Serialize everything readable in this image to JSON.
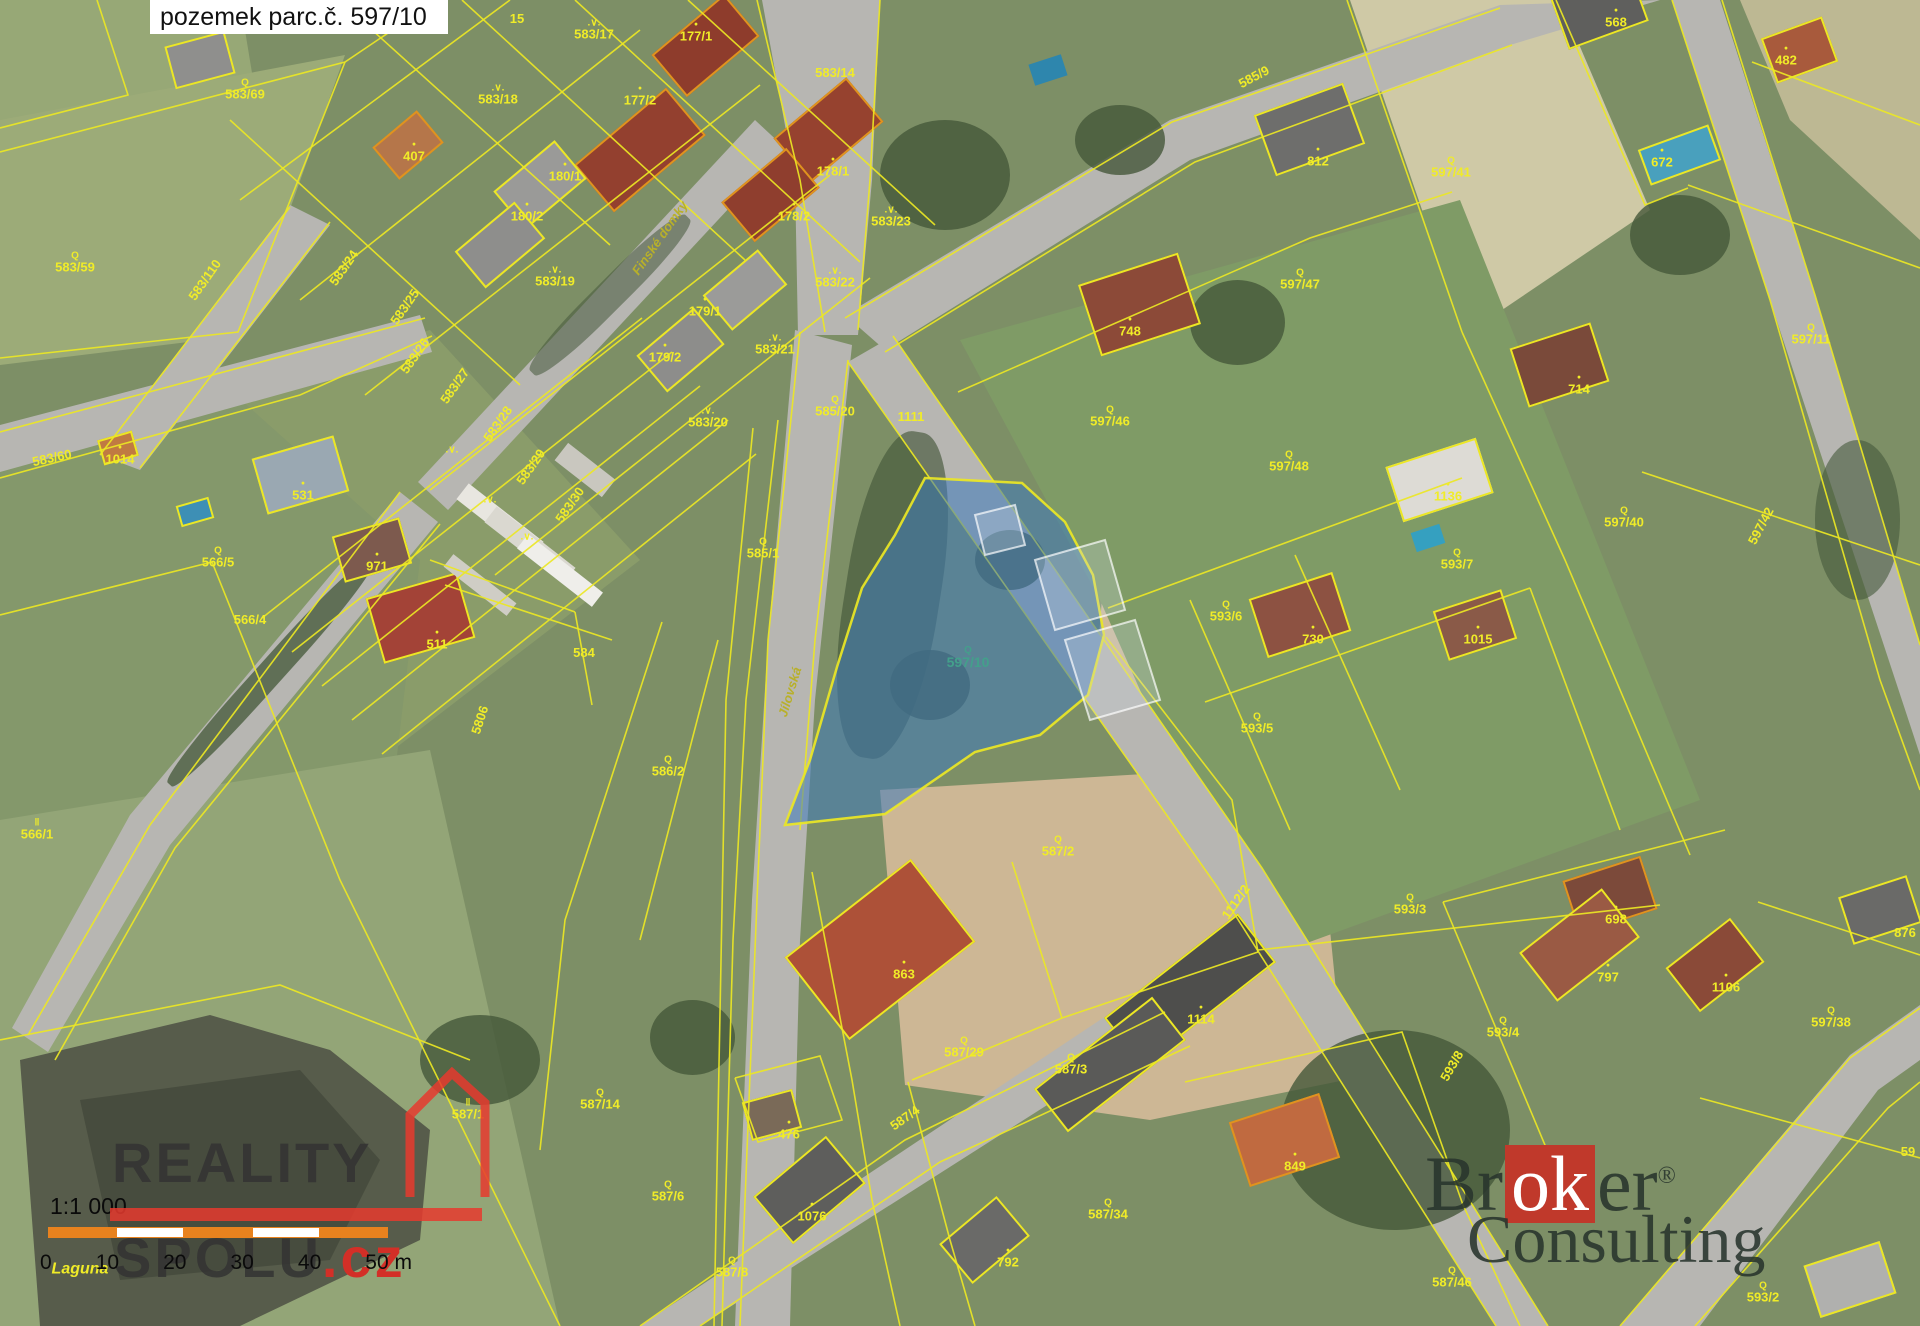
{
  "title": "pozemek parc.č. 597/10",
  "scalebar": {
    "ratio": "1:1 000",
    "ticks": [
      "0",
      "10",
      "20",
      "30",
      "40",
      "50 m"
    ]
  },
  "watermark_left": {
    "word1": "REALITY",
    "word2": "SPOLU",
    "suffix": ".cz"
  },
  "watermark_right": {
    "part1": "Br",
    "accent": "ok",
    "part2": "er",
    "reg": "®",
    "line2": "Consulting"
  },
  "map": {
    "line_color": "#ece724",
    "label_color": "#f0ec28",
    "street_color": "#b8b02a",
    "highlight_parcel": "597/10",
    "highlight_fill": "rgba(62,122,188,0.55)",
    "highlight_label_color": "#43a08b",
    "symbol_glyphs": {
      "Q": "Q",
      "V": ".∨.",
      "II": "‖",
      "dot": "•"
    },
    "parcel_labels": [
      {
        "t": "583/69",
        "x": 245,
        "y": 90,
        "s": "Q"
      },
      {
        "t": "583/59",
        "x": 75,
        "y": 263,
        "s": "Q"
      },
      {
        "t": "583/110",
        "x": 205,
        "y": 280,
        "r": -55
      },
      {
        "t": "407",
        "x": 414,
        "y": 152,
        "s": "dot"
      },
      {
        "t": "583/24",
        "x": 344,
        "y": 268,
        "r": -55
      },
      {
        "t": "583/25",
        "x": 405,
        "y": 307,
        "r": -55
      },
      {
        "t": "583/26",
        "x": 415,
        "y": 356,
        "r": -55
      },
      {
        "t": "583/27",
        "x": 455,
        "y": 386,
        "r": -55
      },
      {
        "t": "583/28",
        "x": 498,
        "y": 424,
        "r": -55
      },
      {
        "t": "583/29",
        "x": 531,
        "y": 467,
        "r": -55
      },
      {
        "t": "583/30",
        "x": 570,
        "y": 505,
        "r": -55
      },
      {
        "t": "15",
        "x": 517,
        "y": 19
      },
      {
        "t": "583/17",
        "x": 594,
        "y": 30,
        "s": "V"
      },
      {
        "t": "583/18",
        "x": 498,
        "y": 95,
        "s": "V"
      },
      {
        "t": "177/1",
        "x": 696,
        "y": 32,
        "s": "dot"
      },
      {
        "t": "177/2",
        "x": 640,
        "y": 96,
        "s": "dot"
      },
      {
        "t": "180/1",
        "x": 565,
        "y": 172,
        "s": "dot"
      },
      {
        "t": "180/2",
        "x": 527,
        "y": 212,
        "s": "dot"
      },
      {
        "t": "178/1",
        "x": 833,
        "y": 167,
        "s": "dot"
      },
      {
        "t": "178/2",
        "x": 794,
        "y": 212,
        "s": "dot"
      },
      {
        "t": "583/23",
        "x": 891,
        "y": 217,
        "s": "V"
      },
      {
        "t": "583/14",
        "x": 835,
        "y": 73
      },
      {
        "t": "583/22",
        "x": 835,
        "y": 278,
        "s": "V"
      },
      {
        "t": "583/19",
        "x": 555,
        "y": 277,
        "s": "V"
      },
      {
        "t": "179/1",
        "x": 705,
        "y": 307,
        "s": "dot"
      },
      {
        "t": "179/2",
        "x": 665,
        "y": 353,
        "s": "dot"
      },
      {
        "t": "583/21",
        "x": 775,
        "y": 345,
        "s": "V"
      },
      {
        "t": "583/20",
        "x": 708,
        "y": 418,
        "s": "V"
      },
      {
        "t": "585/20",
        "x": 835,
        "y": 407,
        "s": "Q"
      },
      {
        "t": "1111",
        "x": 911,
        "y": 417
      },
      {
        "t": "585/1",
        "x": 763,
        "y": 549,
        "s": "Q"
      },
      {
        "t": "1014",
        "x": 120,
        "y": 455,
        "s": "dot"
      },
      {
        "t": "583/60",
        "x": 52,
        "y": 458,
        "r": -12
      },
      {
        "t": "531",
        "x": 303,
        "y": 491,
        "s": "dot"
      },
      {
        "t": "566/5",
        "x": 218,
        "y": 558,
        "s": "Q"
      },
      {
        "t": "971",
        "x": 377,
        "y": 562,
        "s": "dot"
      },
      {
        "t": "511",
        "x": 437,
        "y": 640,
        "s": "dot"
      },
      {
        "t": "566/4",
        "x": 250,
        "y": 620
      },
      {
        "t": "584",
        "x": 584,
        "y": 653
      },
      {
        "t": "5806",
        "x": 480,
        "y": 720,
        "r": -72
      },
      {
        "t": "586/2",
        "x": 668,
        "y": 767,
        "s": "Q"
      },
      {
        "t": "597/10",
        "x": 968,
        "y": 658,
        "s": "Q",
        "c": "hl"
      },
      {
        "t": "587/2",
        "x": 1058,
        "y": 847,
        "s": "Q"
      },
      {
        "t": "1112/2",
        "x": 1236,
        "y": 902,
        "r": -55
      },
      {
        "t": "863",
        "x": 904,
        "y": 970,
        "s": "dot"
      },
      {
        "t": "587/29",
        "x": 964,
        "y": 1048,
        "s": "Q"
      },
      {
        "t": "587/3",
        "x": 1071,
        "y": 1065,
        "s": "Q"
      },
      {
        "t": "1114",
        "x": 1201,
        "y": 1015,
        "s": "dot"
      },
      {
        "t": "476",
        "x": 789,
        "y": 1130,
        "s": "dot"
      },
      {
        "t": "587/14",
        "x": 600,
        "y": 1100,
        "s": "Q"
      },
      {
        "t": "587/1",
        "x": 468,
        "y": 1110,
        "s": "II"
      },
      {
        "t": "566/1",
        "x": 37,
        "y": 830,
        "s": "II"
      },
      {
        "t": "587/6",
        "x": 668,
        "y": 1192,
        "s": "Q"
      },
      {
        "t": "587/8",
        "x": 732,
        "y": 1268,
        "s": "Q"
      },
      {
        "t": "1076",
        "x": 812,
        "y": 1212,
        "s": "dot"
      },
      {
        "t": "792",
        "x": 1008,
        "y": 1258,
        "s": "dot"
      },
      {
        "t": "587/34",
        "x": 1108,
        "y": 1210,
        "s": "Q"
      },
      {
        "t": "587/4",
        "x": 905,
        "y": 1118,
        "r": -35
      },
      {
        "t": "849",
        "x": 1295,
        "y": 1162,
        "s": "dot"
      },
      {
        "t": "587/46",
        "x": 1452,
        "y": 1278,
        "s": "Q"
      },
      {
        "t": "593/2",
        "x": 1763,
        "y": 1293,
        "s": "Q"
      },
      {
        "t": "597/38",
        "x": 1831,
        "y": 1018,
        "s": "Q"
      },
      {
        "t": "593/4",
        "x": 1503,
        "y": 1028,
        "s": "Q"
      },
      {
        "t": "797",
        "x": 1608,
        "y": 973,
        "s": "dot"
      },
      {
        "t": "1106",
        "x": 1726,
        "y": 983,
        "s": "dot"
      },
      {
        "t": "876",
        "x": 1905,
        "y": 933
      },
      {
        "t": "593/8",
        "x": 1452,
        "y": 1066,
        "r": -60
      },
      {
        "t": "698",
        "x": 1616,
        "y": 915,
        "s": "dot"
      },
      {
        "t": "593/3",
        "x": 1410,
        "y": 905,
        "s": "Q"
      },
      {
        "t": "593/5",
        "x": 1257,
        "y": 724,
        "s": "Q"
      },
      {
        "t": "593/6",
        "x": 1226,
        "y": 612,
        "s": "Q"
      },
      {
        "t": "593/7",
        "x": 1457,
        "y": 560,
        "s": "Q"
      },
      {
        "t": "730",
        "x": 1313,
        "y": 635,
        "s": "dot"
      },
      {
        "t": "1015",
        "x": 1478,
        "y": 635,
        "s": "dot"
      },
      {
        "t": "1136",
        "x": 1448,
        "y": 492,
        "s": "dot"
      },
      {
        "t": "597/48",
        "x": 1289,
        "y": 462,
        "s": "Q"
      },
      {
        "t": "597/46",
        "x": 1110,
        "y": 417,
        "s": "Q"
      },
      {
        "t": "748",
        "x": 1130,
        "y": 327,
        "s": "dot"
      },
      {
        "t": "597/47",
        "x": 1300,
        "y": 280,
        "s": "Q"
      },
      {
        "t": "585/9",
        "x": 1254,
        "y": 77,
        "r": -28
      },
      {
        "t": "812",
        "x": 1318,
        "y": 157,
        "s": "dot"
      },
      {
        "t": "568",
        "x": 1616,
        "y": 18,
        "s": "dot"
      },
      {
        "t": "672",
        "x": 1662,
        "y": 158,
        "s": "dot"
      },
      {
        "t": "482",
        "x": 1786,
        "y": 56,
        "s": "dot"
      },
      {
        "t": "597/41",
        "x": 1451,
        "y": 168,
        "s": "Q"
      },
      {
        "t": "597/11",
        "x": 1811,
        "y": 335,
        "s": "Q"
      },
      {
        "t": "714",
        "x": 1579,
        "y": 385,
        "s": "dot"
      },
      {
        "t": "597/40",
        "x": 1624,
        "y": 518,
        "s": "Q"
      },
      {
        "t": "597/42",
        "x": 1761,
        "y": 526,
        "r": -62
      },
      {
        "t": "59",
        "x": 1908,
        "y": 1152
      },
      {
        "t": "",
        "x": 452,
        "y": 450,
        "s": "V"
      },
      {
        "t": "",
        "x": 490,
        "y": 500,
        "s": "V"
      },
      {
        "t": "",
        "x": 527,
        "y": 537,
        "s": "V"
      },
      {
        "t": "Finské domky",
        "x": 660,
        "y": 238,
        "r": -55,
        "c": "st"
      },
      {
        "t": "Jílovská",
        "x": 790,
        "y": 692,
        "r": -73,
        "c": "st"
      },
      {
        "t": "Laguna",
        "x": 80,
        "y": 1270,
        "c": "wt"
      }
    ]
  }
}
